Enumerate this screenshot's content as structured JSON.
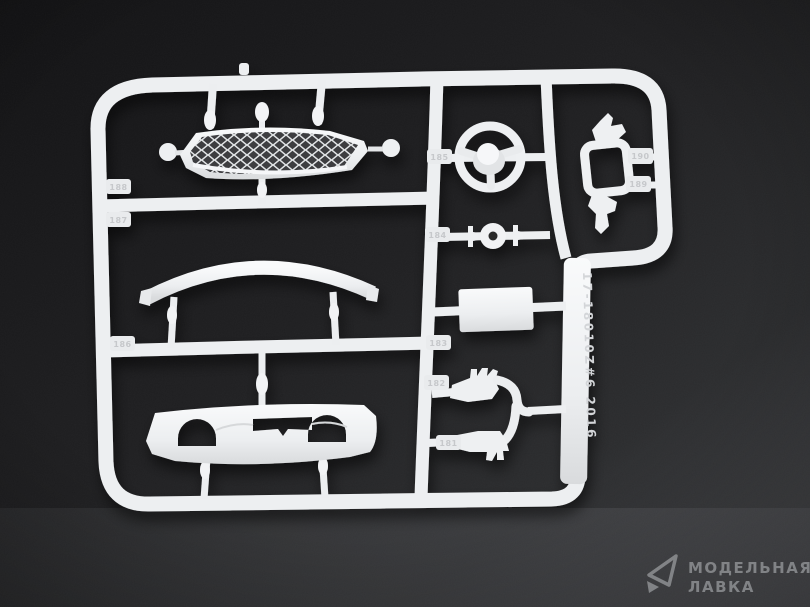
{
  "scene": {
    "caption": "White plastic model kit sprue with car parts on dark textured backdrop"
  },
  "background": {
    "top_left_color": "#121214",
    "mid_color": "#222224",
    "bottom_right_color": "#4b4c50"
  },
  "sprue": {
    "plastic_color": "#eef0f2",
    "embossed_code": "17-18010Z#6 2016",
    "tabs": [
      "188",
      "187",
      "186",
      "185",
      "184",
      "183",
      "182",
      "181",
      "190",
      "189"
    ],
    "parts": [
      "radiator-grille",
      "rear-spoiler-strip",
      "rear-diffuser",
      "steering-wheel",
      "drive-joint",
      "rectangular-box",
      "exhaust-tip-upper",
      "exhaust-tip-lower",
      "mounting-frame"
    ]
  },
  "watermark": {
    "line1": "МОДЕЛЬНАЯ",
    "line2": "ЛАВКА",
    "icon": "paper-plane-icon",
    "color": "#8e9093"
  }
}
